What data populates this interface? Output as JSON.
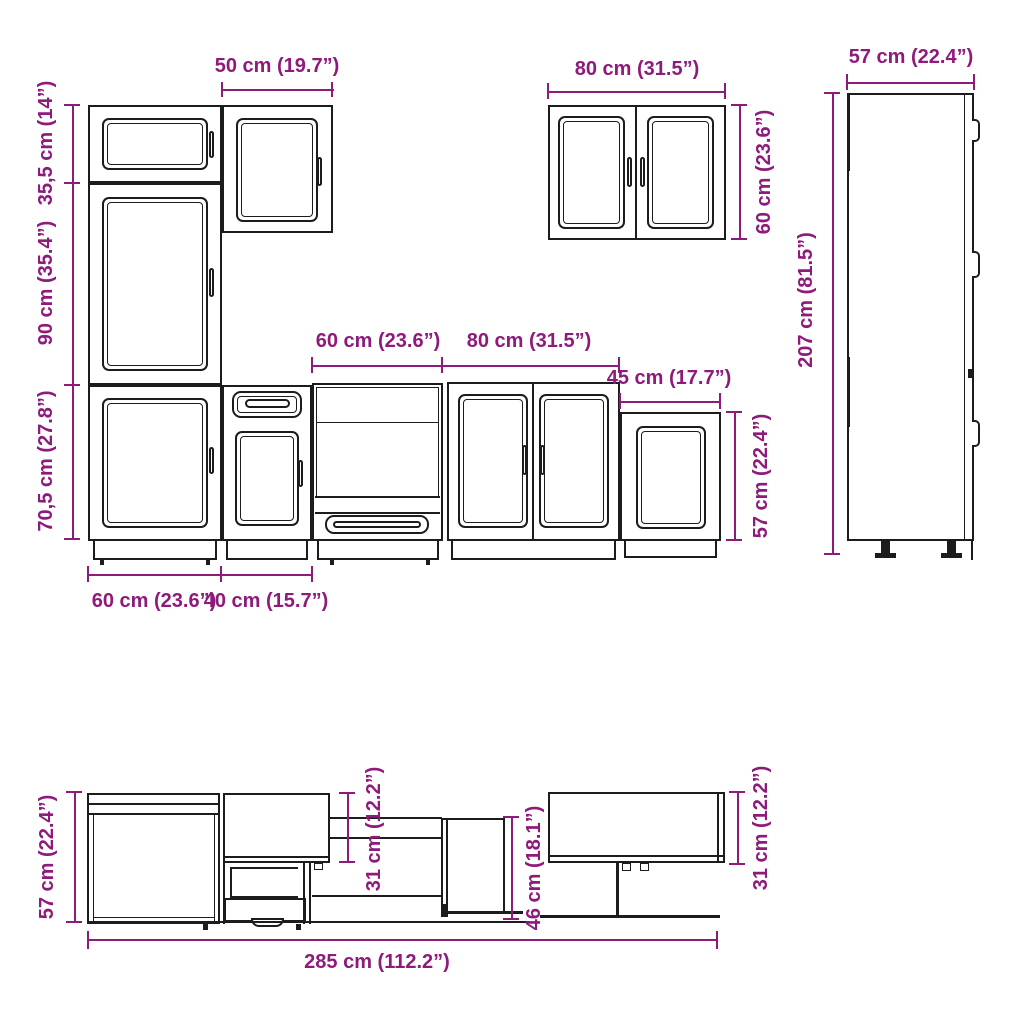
{
  "accent_color": "#8E1A7B",
  "line_color": "#1c1c1c",
  "front_view": {
    "wall_cabinet_50_width": "50 cm (19.7”)",
    "upper_section_height": "35,5 cm (14”)",
    "tall_section_height": "90 cm (35.4”)",
    "base_section_height": "70,5 cm (27.8”)",
    "base_60_width": "60 cm (23.6”)",
    "base_40_width": "40 cm (15.7”)",
    "oven_unit_width": "60 cm (23.6”)",
    "base_80_width": "80 cm (31.5”)",
    "base_45_width": "45 cm (17.7”)",
    "base_45_height": "57 cm (22.4”)",
    "wall_cabinet_80_width": "80 cm (31.5”)",
    "wall_cabinet_80_height": "60 cm (23.6”)",
    "tall_cabinet_depth": "57 cm (22.4”)",
    "tall_cabinet_height": "207 cm (81.5”)"
  },
  "side_view": {
    "base_cabinet_height": "57 cm (22.4”)",
    "wall_cabinet_depth_left": "31 cm (12.2”)",
    "mid_cabinet_height": "46 cm (18.1”)",
    "wall_cabinet_depth_right": "31 cm (12.2”)",
    "total_run_width": "285 cm (112.2”)"
  }
}
